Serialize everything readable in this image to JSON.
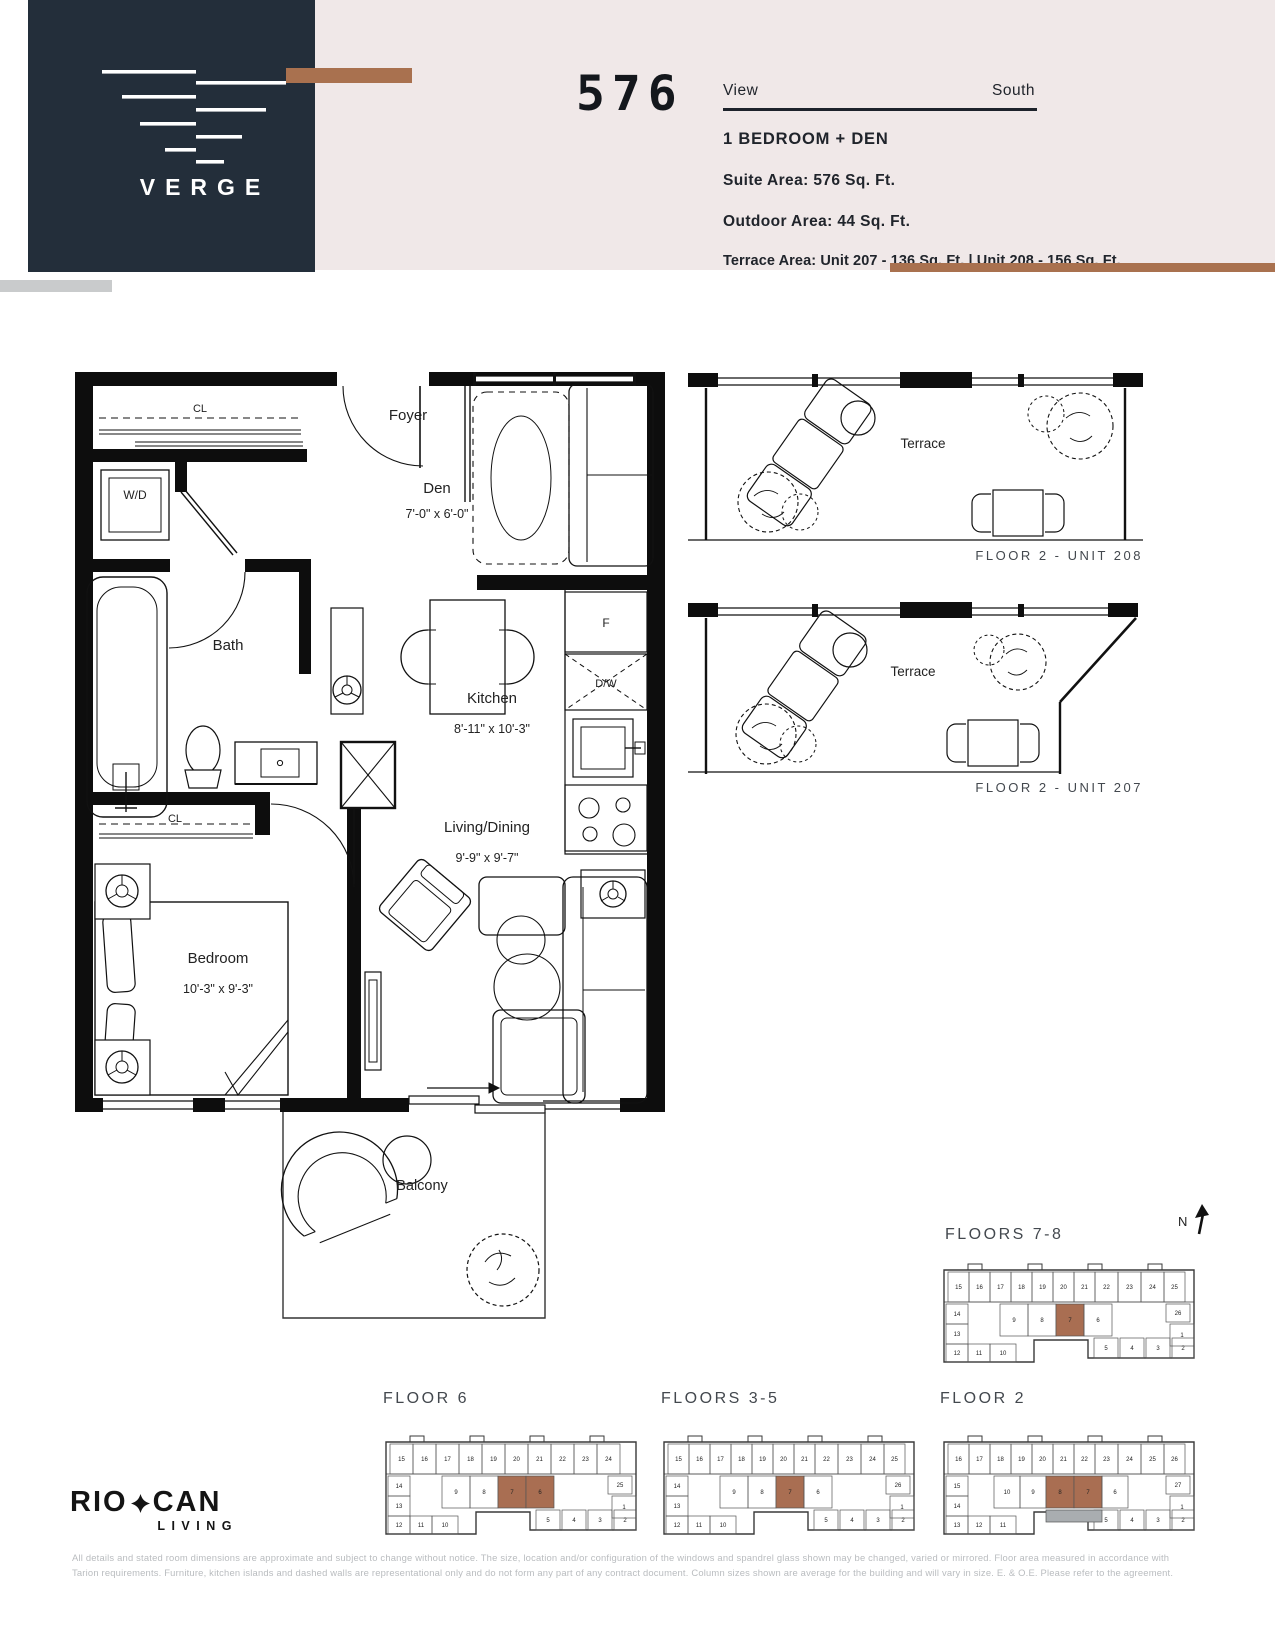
{
  "colors": {
    "navy": "#232e3a",
    "blush": "#f0e8e8",
    "copper": "#a9714f",
    "highlight": "#a96e52",
    "terrace_gray": "#a9adb0",
    "disclaimer": "#b9bcbf"
  },
  "header": {
    "brand": "VERGE",
    "unit_number": "576",
    "view_label": "View",
    "view_value": "South",
    "suite_type": "1 BEDROOM + DEN",
    "suite_area": "Suite Area: 576 Sq. Ft.",
    "outdoor_area": "Outdoor Area: 44 Sq. Ft.",
    "terrace_area": "Terrace Area: Unit 207 - 136 Sq. Ft. | Unit 208 - 156 Sq. Ft."
  },
  "plan": {
    "foyer": "Foyer",
    "den": {
      "name": "Den",
      "dim": "7'-0\" x 6'-0\""
    },
    "wd": "W/D",
    "bath": "Bath",
    "kitchen": {
      "name": "Kitchen",
      "dim": "8'-11\" x 10'-3\""
    },
    "living": {
      "name": "Living/Dining",
      "dim": "9'-9\" x 9'-7\""
    },
    "bedroom": {
      "name": "Bedroom",
      "dim": "10'-3\" x 9'-3\""
    },
    "balcony": "Balcony",
    "closet_top": "CL",
    "closet_bedroom": "CL",
    "fridge": "F",
    "dishwasher": "D/W"
  },
  "terraces": [
    {
      "label": "Terrace",
      "caption": "FLOOR 2 - UNIT 208"
    },
    {
      "label": "Terrace",
      "caption": "FLOOR 2 - UNIT 207"
    }
  ],
  "compass": {
    "label": "N"
  },
  "keyplans": [
    {
      "id": "kp78",
      "title": "FLOORS 7-8",
      "outline": "M6,24 H256 V112 H150 V94 H96 V116 H6 Z",
      "bumps": [
        [
          30,
          18
        ],
        [
          90,
          18
        ],
        [
          150,
          18
        ],
        [
          210,
          18
        ]
      ],
      "cells": [
        {
          "n": "15",
          "x": 10,
          "y": 26,
          "w": 21,
          "h": 30
        },
        {
          "n": "16",
          "x": 31,
          "y": 26,
          "w": 21,
          "h": 30
        },
        {
          "n": "17",
          "x": 52,
          "y": 26,
          "w": 21,
          "h": 30
        },
        {
          "n": "18",
          "x": 73,
          "y": 26,
          "w": 21,
          "h": 30
        },
        {
          "n": "19",
          "x": 94,
          "y": 26,
          "w": 21,
          "h": 30
        },
        {
          "n": "20",
          "x": 115,
          "y": 26,
          "w": 21,
          "h": 30
        },
        {
          "n": "21",
          "x": 136,
          "y": 26,
          "w": 21,
          "h": 30
        },
        {
          "n": "22",
          "x": 157,
          "y": 26,
          "w": 23,
          "h": 30
        },
        {
          "n": "23",
          "x": 180,
          "y": 26,
          "w": 23,
          "h": 30
        },
        {
          "n": "24",
          "x": 203,
          "y": 26,
          "w": 23,
          "h": 30
        },
        {
          "n": "25",
          "x": 226,
          "y": 26,
          "w": 21,
          "h": 30
        },
        {
          "n": "14",
          "x": 8,
          "y": 58,
          "w": 22,
          "h": 20
        },
        {
          "n": "13",
          "x": 8,
          "y": 78,
          "w": 22,
          "h": 20
        },
        {
          "n": "9",
          "x": 62,
          "y": 58,
          "w": 28,
          "h": 32
        },
        {
          "n": "8",
          "x": 90,
          "y": 58,
          "w": 28,
          "h": 32
        },
        {
          "n": "7",
          "x": 118,
          "y": 58,
          "w": 28,
          "h": 32,
          "hl": true
        },
        {
          "n": "6",
          "x": 146,
          "y": 58,
          "w": 28,
          "h": 32
        },
        {
          "n": "26",
          "x": 228,
          "y": 58,
          "w": 24,
          "h": 18
        },
        {
          "n": "1",
          "x": 232,
          "y": 78,
          "w": 24,
          "h": 22
        },
        {
          "n": "12",
          "x": 8,
          "y": 98,
          "w": 22,
          "h": 18
        },
        {
          "n": "11",
          "x": 30,
          "y": 98,
          "w": 22,
          "h": 18
        },
        {
          "n": "10",
          "x": 52,
          "y": 98,
          "w": 26,
          "h": 18
        },
        {
          "n": "5",
          "x": 156,
          "y": 92,
          "w": 24,
          "h": 20
        },
        {
          "n": "4",
          "x": 182,
          "y": 92,
          "w": 24,
          "h": 20
        },
        {
          "n": "3",
          "x": 208,
          "y": 92,
          "w": 24,
          "h": 20
        },
        {
          "n": "2",
          "x": 234,
          "y": 92,
          "w": 22,
          "h": 20
        }
      ]
    },
    {
      "id": "kp6",
      "title": "FLOOR 6",
      "outline": "M6,24 H256 V112 H150 V94 H96 V116 H6 Z",
      "bumps": [
        [
          30,
          18
        ],
        [
          90,
          18
        ],
        [
          150,
          18
        ],
        [
          210,
          18
        ]
      ],
      "cells": [
        {
          "n": "15",
          "x": 10,
          "y": 26,
          "w": 23,
          "h": 30
        },
        {
          "n": "16",
          "x": 33,
          "y": 26,
          "w": 23,
          "h": 30
        },
        {
          "n": "17",
          "x": 56,
          "y": 26,
          "w": 23,
          "h": 30
        },
        {
          "n": "18",
          "x": 79,
          "y": 26,
          "w": 23,
          "h": 30
        },
        {
          "n": "19",
          "x": 102,
          "y": 26,
          "w": 23,
          "h": 30
        },
        {
          "n": "20",
          "x": 125,
          "y": 26,
          "w": 23,
          "h": 30
        },
        {
          "n": "21",
          "x": 148,
          "y": 26,
          "w": 23,
          "h": 30
        },
        {
          "n": "22",
          "x": 171,
          "y": 26,
          "w": 23,
          "h": 30
        },
        {
          "n": "23",
          "x": 194,
          "y": 26,
          "w": 23,
          "h": 30
        },
        {
          "n": "24",
          "x": 217,
          "y": 26,
          "w": 23,
          "h": 30
        },
        {
          "n": "14",
          "x": 8,
          "y": 58,
          "w": 22,
          "h": 20
        },
        {
          "n": "13",
          "x": 8,
          "y": 78,
          "w": 22,
          "h": 20
        },
        {
          "n": "9",
          "x": 62,
          "y": 58,
          "w": 28,
          "h": 32
        },
        {
          "n": "8",
          "x": 90,
          "y": 58,
          "w": 28,
          "h": 32
        },
        {
          "n": "7",
          "x": 118,
          "y": 58,
          "w": 28,
          "h": 32,
          "hl": true
        },
        {
          "n": "6",
          "x": 146,
          "y": 58,
          "w": 28,
          "h": 32,
          "hl": true
        },
        {
          "n": "25",
          "x": 228,
          "y": 58,
          "w": 24,
          "h": 18
        },
        {
          "n": "1",
          "x": 232,
          "y": 78,
          "w": 24,
          "h": 22
        },
        {
          "n": "12",
          "x": 8,
          "y": 98,
          "w": 22,
          "h": 18
        },
        {
          "n": "11",
          "x": 30,
          "y": 98,
          "w": 22,
          "h": 18
        },
        {
          "n": "10",
          "x": 52,
          "y": 98,
          "w": 26,
          "h": 18
        },
        {
          "n": "5",
          "x": 156,
          "y": 92,
          "w": 24,
          "h": 20
        },
        {
          "n": "4",
          "x": 182,
          "y": 92,
          "w": 24,
          "h": 20
        },
        {
          "n": "3",
          "x": 208,
          "y": 92,
          "w": 24,
          "h": 20
        },
        {
          "n": "2",
          "x": 234,
          "y": 92,
          "w": 22,
          "h": 20
        }
      ]
    },
    {
      "id": "kp35",
      "title": "FLOORS 3-5",
      "outline": "M6,24 H256 V112 H150 V94 H96 V116 H6 Z",
      "bumps": [
        [
          30,
          18
        ],
        [
          90,
          18
        ],
        [
          150,
          18
        ],
        [
          210,
          18
        ]
      ],
      "cells": [
        {
          "n": "15",
          "x": 10,
          "y": 26,
          "w": 21,
          "h": 30
        },
        {
          "n": "16",
          "x": 31,
          "y": 26,
          "w": 21,
          "h": 30
        },
        {
          "n": "17",
          "x": 52,
          "y": 26,
          "w": 21,
          "h": 30
        },
        {
          "n": "18",
          "x": 73,
          "y": 26,
          "w": 21,
          "h": 30
        },
        {
          "n": "19",
          "x": 94,
          "y": 26,
          "w": 21,
          "h": 30
        },
        {
          "n": "20",
          "x": 115,
          "y": 26,
          "w": 21,
          "h": 30
        },
        {
          "n": "21",
          "x": 136,
          "y": 26,
          "w": 21,
          "h": 30
        },
        {
          "n": "22",
          "x": 157,
          "y": 26,
          "w": 23,
          "h": 30
        },
        {
          "n": "23",
          "x": 180,
          "y": 26,
          "w": 23,
          "h": 30
        },
        {
          "n": "24",
          "x": 203,
          "y": 26,
          "w": 23,
          "h": 30
        },
        {
          "n": "25",
          "x": 226,
          "y": 26,
          "w": 21,
          "h": 30
        },
        {
          "n": "14",
          "x": 8,
          "y": 58,
          "w": 22,
          "h": 20
        },
        {
          "n": "13",
          "x": 8,
          "y": 78,
          "w": 22,
          "h": 20
        },
        {
          "n": "9",
          "x": 62,
          "y": 58,
          "w": 28,
          "h": 32
        },
        {
          "n": "8",
          "x": 90,
          "y": 58,
          "w": 28,
          "h": 32
        },
        {
          "n": "7",
          "x": 118,
          "y": 58,
          "w": 28,
          "h": 32,
          "hl": true
        },
        {
          "n": "6",
          "x": 146,
          "y": 58,
          "w": 28,
          "h": 32
        },
        {
          "n": "26",
          "x": 228,
          "y": 58,
          "w": 24,
          "h": 18
        },
        {
          "n": "1",
          "x": 232,
          "y": 78,
          "w": 24,
          "h": 22
        },
        {
          "n": "12",
          "x": 8,
          "y": 98,
          "w": 22,
          "h": 18
        },
        {
          "n": "11",
          "x": 30,
          "y": 98,
          "w": 22,
          "h": 18
        },
        {
          "n": "10",
          "x": 52,
          "y": 98,
          "w": 26,
          "h": 18
        },
        {
          "n": "5",
          "x": 156,
          "y": 92,
          "w": 24,
          "h": 20
        },
        {
          "n": "4",
          "x": 182,
          "y": 92,
          "w": 24,
          "h": 20
        },
        {
          "n": "3",
          "x": 208,
          "y": 92,
          "w": 24,
          "h": 20
        },
        {
          "n": "2",
          "x": 234,
          "y": 92,
          "w": 22,
          "h": 20
        }
      ]
    },
    {
      "id": "kp2",
      "title": "FLOOR 2",
      "outline": "M6,24 H256 V112 H150 V94 H96 V116 H6 Z",
      "bumps": [
        [
          30,
          18
        ],
        [
          90,
          18
        ],
        [
          150,
          18
        ],
        [
          210,
          18
        ]
      ],
      "terrace": [
        108,
        92,
        56,
        12
      ],
      "cells": [
        {
          "n": "16",
          "x": 10,
          "y": 26,
          "w": 21,
          "h": 30
        },
        {
          "n": "17",
          "x": 31,
          "y": 26,
          "w": 21,
          "h": 30
        },
        {
          "n": "18",
          "x": 52,
          "y": 26,
          "w": 21,
          "h": 30
        },
        {
          "n": "19",
          "x": 73,
          "y": 26,
          "w": 21,
          "h": 30
        },
        {
          "n": "20",
          "x": 94,
          "y": 26,
          "w": 21,
          "h": 30
        },
        {
          "n": "21",
          "x": 115,
          "y": 26,
          "w": 21,
          "h": 30
        },
        {
          "n": "22",
          "x": 136,
          "y": 26,
          "w": 21,
          "h": 30
        },
        {
          "n": "23",
          "x": 157,
          "y": 26,
          "w": 23,
          "h": 30
        },
        {
          "n": "24",
          "x": 180,
          "y": 26,
          "w": 23,
          "h": 30
        },
        {
          "n": "25",
          "x": 203,
          "y": 26,
          "w": 23,
          "h": 30
        },
        {
          "n": "26",
          "x": 226,
          "y": 26,
          "w": 21,
          "h": 30
        },
        {
          "n": "15",
          "x": 8,
          "y": 58,
          "w": 22,
          "h": 20
        },
        {
          "n": "14",
          "x": 8,
          "y": 78,
          "w": 22,
          "h": 20
        },
        {
          "n": "10",
          "x": 56,
          "y": 58,
          "w": 26,
          "h": 32
        },
        {
          "n": "9",
          "x": 82,
          "y": 58,
          "w": 26,
          "h": 32
        },
        {
          "n": "8",
          "x": 108,
          "y": 58,
          "w": 28,
          "h": 32,
          "hl": true
        },
        {
          "n": "7",
          "x": 136,
          "y": 58,
          "w": 28,
          "h": 32,
          "hl": true
        },
        {
          "n": "6",
          "x": 164,
          "y": 58,
          "w": 26,
          "h": 32
        },
        {
          "n": "27",
          "x": 228,
          "y": 58,
          "w": 24,
          "h": 18
        },
        {
          "n": "1",
          "x": 232,
          "y": 78,
          "w": 24,
          "h": 22
        },
        {
          "n": "13",
          "x": 8,
          "y": 98,
          "w": 22,
          "h": 18
        },
        {
          "n": "12",
          "x": 30,
          "y": 98,
          "w": 22,
          "h": 18
        },
        {
          "n": "11",
          "x": 52,
          "y": 98,
          "w": 26,
          "h": 18
        },
        {
          "n": "5",
          "x": 156,
          "y": 92,
          "w": 24,
          "h": 20
        },
        {
          "n": "4",
          "x": 182,
          "y": 92,
          "w": 24,
          "h": 20
        },
        {
          "n": "3",
          "x": 208,
          "y": 92,
          "w": 24,
          "h": 20
        },
        {
          "n": "2",
          "x": 234,
          "y": 92,
          "w": 22,
          "h": 20
        }
      ]
    }
  ],
  "footer": {
    "brand_left": "RIO",
    "brand_right": "CAN",
    "brand_sub": "LIVING",
    "disclaimer_line1": "All details and stated room dimensions are approximate and subject to change without notice. The size, location and/or configuration of the windows and spandrel glass shown may be changed, varied or mirrored. Floor area measured in accordance with",
    "disclaimer_line2": "Tarion requirements. Furniture, kitchen islands and dashed walls are representational only and do not form any part of any contract document.  Column sizes shown are average for the building and will vary in size. E. & O.E. Please refer to the agreement."
  }
}
